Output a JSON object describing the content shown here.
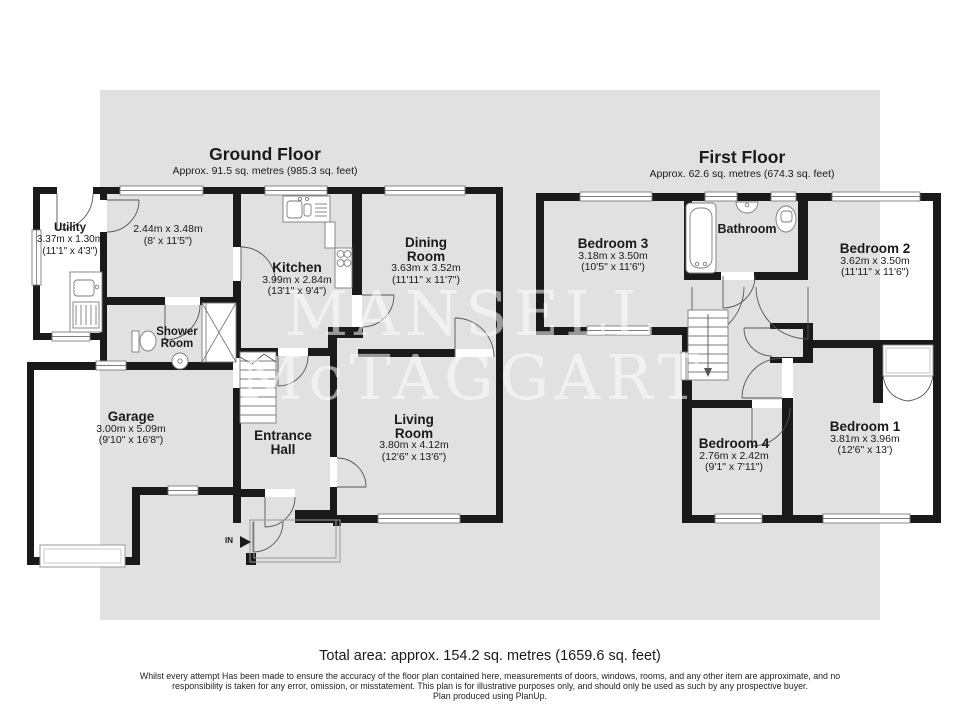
{
  "watermark": {
    "line1": "MANSELL",
    "line2": "McTAGGART"
  },
  "ground_floor": {
    "title": "Ground Floor",
    "subtitle": "Approx. 91.5 sq. metres (985.3 sq. feet)",
    "rooms": {
      "utility": {
        "name": "Utility",
        "dims_m": "3.37m x 1.30m",
        "dims_ft": "(11'1\" x 4'3\")"
      },
      "front_room": {
        "dims_m": "2.44m x 3.48m",
        "dims_ft": "(8' x 11'5\")"
      },
      "kitchen": {
        "name": "Kitchen",
        "dims_m": "3.99m x 2.84m",
        "dims_ft": "(13'1\" x 9'4\")"
      },
      "dining_room": {
        "name_line1": "Dining",
        "name_line2": "Room",
        "dims_m": "3.63m x 3.52m",
        "dims_ft": "(11'11\" x 11'7\")"
      },
      "shower_room": {
        "name_line1": "Shower",
        "name_line2": "Room"
      },
      "garage": {
        "name": "Garage",
        "dims_m": "3.00m x 5.09m",
        "dims_ft": "(9'10\" x 16'8\")"
      },
      "entrance_hall": {
        "name_line1": "Entrance",
        "name_line2": "Hall"
      },
      "living_room": {
        "name_line1": "Living",
        "name_line2": "Room",
        "dims_m": "3.80m x 4.12m",
        "dims_ft": "(12'6\" x 13'6\")"
      },
      "entry_marker": "IN"
    }
  },
  "first_floor": {
    "title": "First Floor",
    "subtitle": "Approx. 62.6 sq. metres (674.3 sq. feet)",
    "rooms": {
      "bedroom3": {
        "name": "Bedroom 3",
        "dims_m": "3.18m x 3.50m",
        "dims_ft": "(10'5\" x 11'6\")"
      },
      "bathroom": {
        "name": "Bathroom"
      },
      "bedroom2": {
        "name": "Bedroom 2",
        "dims_m": "3.62m x 3.50m",
        "dims_ft": "(11'11\" x 11'6\")"
      },
      "bedroom4": {
        "name": "Bedroom 4",
        "dims_m": "2.76m x 2.42m",
        "dims_ft": "(9'1\" x 7'11\")"
      },
      "bedroom1": {
        "name": "Bedroom 1",
        "dims_m": "3.81m x 3.96m",
        "dims_ft": "(12'6\" x 13')"
      }
    }
  },
  "footer": {
    "total_area": "Total area: approx. 154.2 sq. metres (1659.6 sq. feet)",
    "disclaimer_line1": "Whilst every attempt Has been made to ensure the accuracy of the floor plan contained here, measurements of doors, windows, rooms, and any other item are approximate, and no",
    "disclaimer_line2": "responsibility is taken for any error, omission, or misstatement. This plan is for illustrative purposes only, and should only be used as such by any prospective buyer.",
    "disclaimer_line3": "Plan produced using PlanUp."
  },
  "colors": {
    "wall": "#1a1a1a",
    "background_panel": "#e1e1e1",
    "fixture_stroke": "#7d7d7d",
    "door_arc": "#555555"
  }
}
